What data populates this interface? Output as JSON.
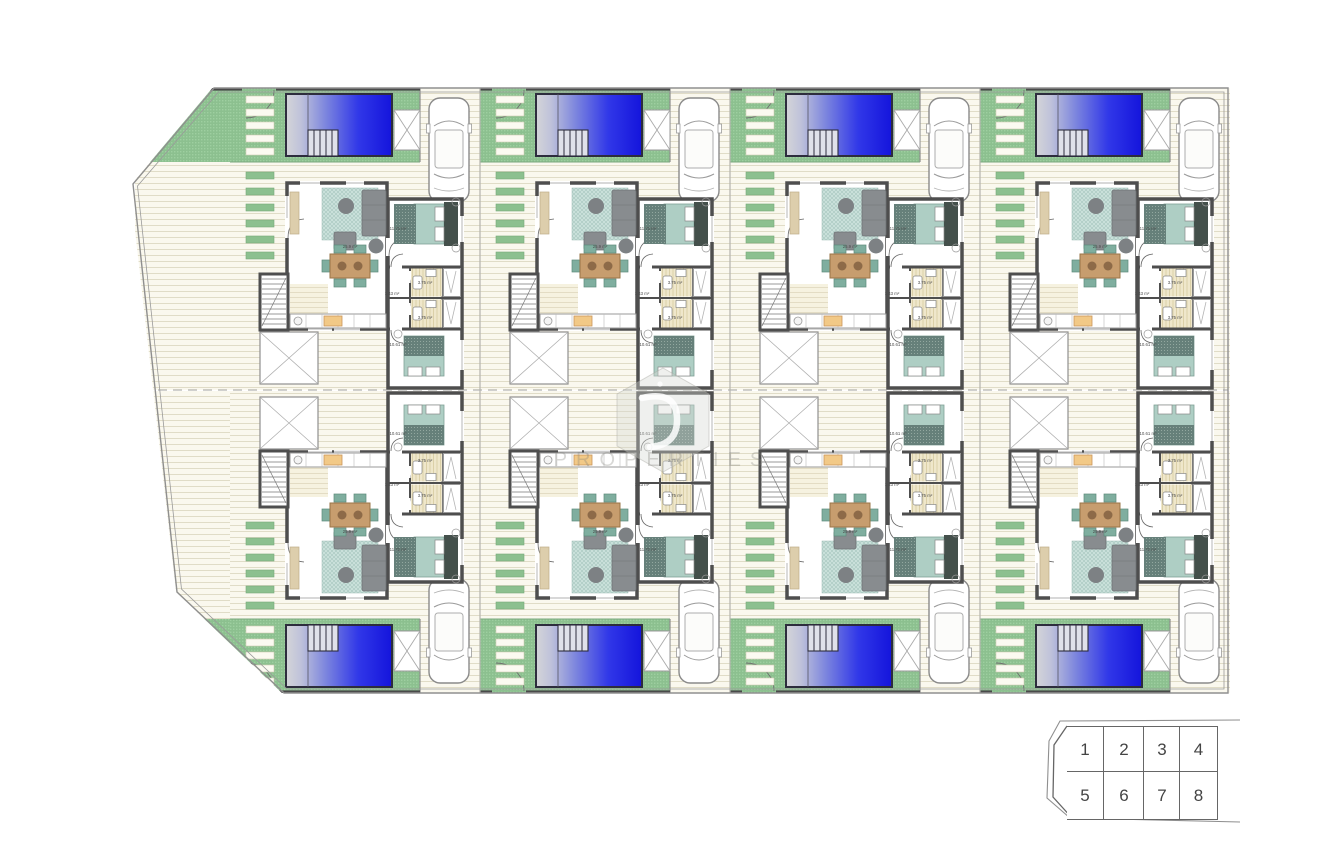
{
  "watermark": {
    "logo": "hexagon-d-logo",
    "text": "PROPERTIES"
  },
  "site": {
    "colors": {
      "pool_blue": "#1414dc",
      "lawn_green": "#8cc08f",
      "terrace_cream": "#faf8ee",
      "wall_gray": "#4e4e4e",
      "bed_teal": "#aecec4",
      "wood_brown": "#c79d6e"
    },
    "rows": [
      [
        "1",
        "2",
        "3",
        "4"
      ],
      [
        "5",
        "6",
        "7",
        "8"
      ]
    ],
    "villas": [
      {
        "plot": "1",
        "row": "top",
        "col": 0,
        "labels": {
          "living": "25.9 m²",
          "bedroom_1": "11.71 m²",
          "bedroom_2": "10.61 m²",
          "bathroom_1": "3.75 m²",
          "bathroom_2": "3.75 m²",
          "hall": "1.43 m²"
        }
      },
      {
        "plot": "2",
        "row": "top",
        "col": 1,
        "labels": {
          "living": "25.9 m²",
          "bedroom_1": "11.71 m²",
          "bedroom_2": "10.61 m²",
          "bathroom_1": "3.75 m²",
          "bathroom_2": "3.75 m²",
          "hall": "1.43 m²"
        }
      },
      {
        "plot": "3",
        "row": "top",
        "col": 2,
        "labels": {
          "living": "25.9 m²",
          "bedroom_1": "11.71 m²",
          "bedroom_2": "10.61 m²",
          "bathroom_1": "3.75 m²",
          "bathroom_2": "3.75 m²",
          "hall": "1.43 m²"
        }
      },
      {
        "plot": "4",
        "row": "top",
        "col": 3,
        "labels": {
          "living": "25.9 m²",
          "bedroom_1": "11.71 m²",
          "bedroom_2": "10.61 m²",
          "bathroom_1": "3.75 m²",
          "bathroom_2": "3.75 m²",
          "hall": "1.43 m²"
        }
      },
      {
        "plot": "5",
        "row": "bottom",
        "col": 0,
        "labels": {
          "living": "25.9 m²",
          "bedroom_1": "11.71 m²",
          "bedroom_2": "10.61 m²",
          "bathroom_1": "3.75 m²",
          "bathroom_2": "3.75 m²",
          "hall": "1.43 m²"
        }
      },
      {
        "plot": "6",
        "row": "bottom",
        "col": 1,
        "labels": {
          "living": "25.9 m²",
          "bedroom_1": "11.71 m²",
          "bedroom_2": "10.61 m²",
          "bathroom_1": "3.75 m²",
          "bathroom_2": "3.75 m²",
          "hall": "1.43 m²"
        }
      },
      {
        "plot": "7",
        "row": "bottom",
        "col": 2,
        "labels": {
          "living": "25.9 m²",
          "bedroom_1": "11.71 m²",
          "bedroom_2": "10.61 m²",
          "bathroom_1": "3.75 m²",
          "bathroom_2": "3.75 m²",
          "hall": "1.43 m²"
        }
      },
      {
        "plot": "8",
        "row": "bottom",
        "col": 3,
        "labels": {
          "living": "25.9 m²",
          "bedroom_1": "11.71 m²",
          "bedroom_2": "10.61 m²",
          "bathroom_1": "3.75 m²",
          "bathroom_2": "3.75 m²",
          "hall": "1.43 m²"
        }
      }
    ]
  },
  "keyplan": {
    "cells": [
      "1",
      "2",
      "3",
      "4",
      "5",
      "6",
      "7",
      "8"
    ]
  }
}
